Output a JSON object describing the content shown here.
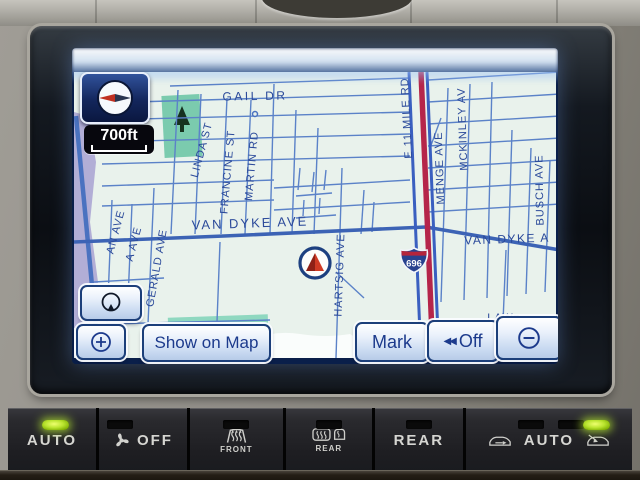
{
  "nav": {
    "scale_label": "700ft",
    "buttons": {
      "show_on_map": "Show on Map",
      "mark": "Mark",
      "off": "Off",
      "off_prefix": "◀◀"
    },
    "map": {
      "highway_shield": "696",
      "streets": [
        {
          "text": "GAIL DR"
        },
        {
          "text": "E 11 MILE RD"
        },
        {
          "text": "MENGE AVE"
        },
        {
          "text": "MCKINLEY AV"
        },
        {
          "text": "BUSCH AVE"
        },
        {
          "text": "LINDA ST"
        },
        {
          "text": "FRANCINE ST"
        },
        {
          "text": "MARTIN RD"
        },
        {
          "text": "VAN DYKE AVE"
        },
        {
          "text": "VAN DYKE A"
        },
        {
          "text": "AN AVE"
        },
        {
          "text": "A AVE"
        },
        {
          "text": "GERALD AVE"
        },
        {
          "text": "HARTSIG AVE"
        },
        {
          "text": "LAWn"
        },
        {
          "text": "H"
        }
      ]
    }
  },
  "climate": {
    "buttons": [
      {
        "label": "AUTO",
        "led": "on"
      },
      {
        "label": "OFF"
      },
      {
        "label": "FRONT"
      },
      {
        "label": "REAR"
      },
      {
        "label": "REAR"
      },
      {
        "label": "AUTO",
        "led": "on"
      }
    ]
  },
  "colors": {
    "led_green": "#b8e32e",
    "map_background": "#e9f2ec",
    "road_blue": "#4a72c0",
    "highway_red": "#b5254a",
    "label_navy": "#2b4a9a"
  }
}
